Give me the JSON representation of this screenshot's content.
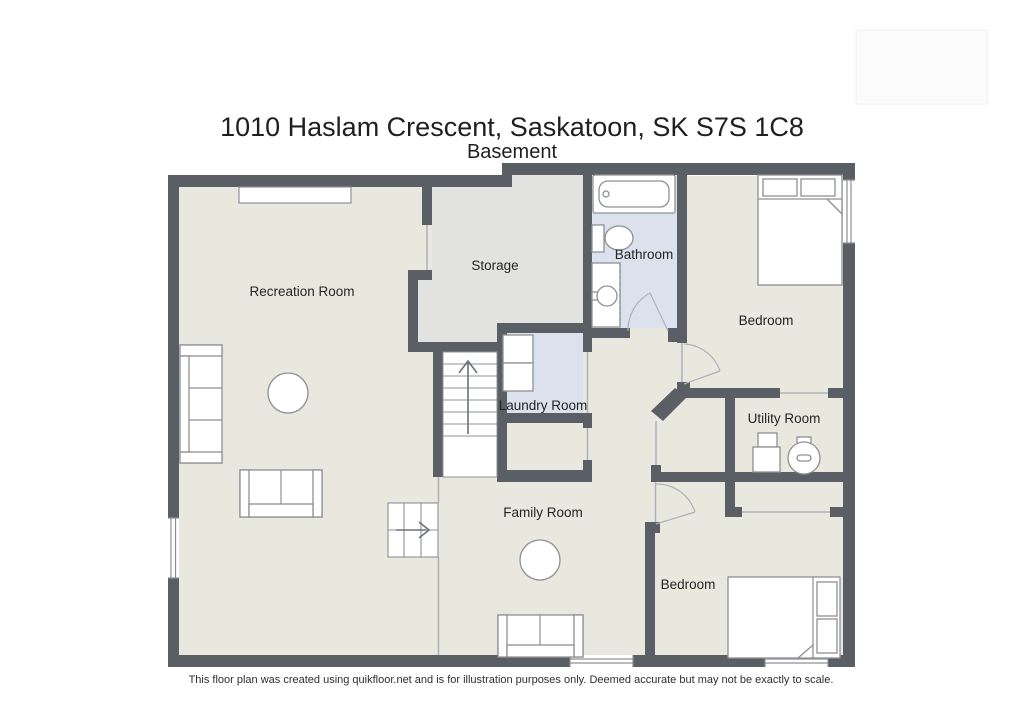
{
  "header": {
    "title": "1010 Haslam Crescent, Saskatoon, SK S7S 1C8",
    "subtitle": "Basement"
  },
  "footer": {
    "disclaimer": "This floor plan was created using quikfloor.net and is for illustration purposes only. Deemed accurate but may not be exactly to scale."
  },
  "floorplan": {
    "rooms": [
      {
        "label": "Recreation Room"
      },
      {
        "label": "Storage"
      },
      {
        "label": "Bathroom"
      },
      {
        "label": "Bedroom"
      },
      {
        "label": "Laundry Room"
      },
      {
        "label": "Utility Room"
      },
      {
        "label": "Family Room"
      },
      {
        "label": "Bedroom"
      }
    ],
    "colors": {
      "wall": "#5a5f66",
      "floor_main": "#e9e8df",
      "floor_storage": "#e2e2e0",
      "floor_wet": "#dbe2ed",
      "furniture_stroke": "#8d9094",
      "opening": "#aeb2b8"
    }
  }
}
